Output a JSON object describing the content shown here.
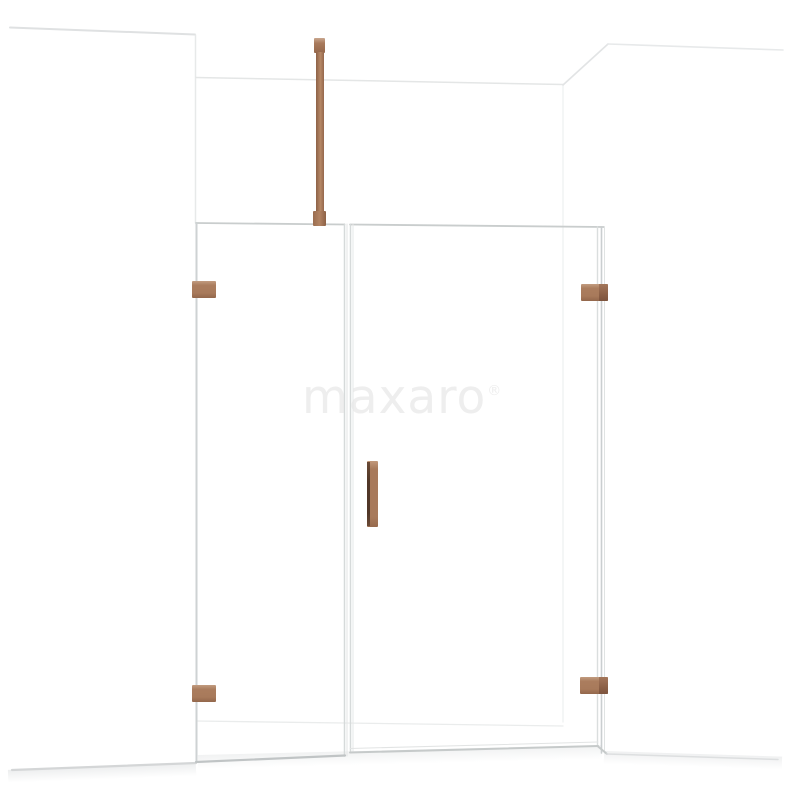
{
  "scene": {
    "background_color": "#ffffff",
    "subject": "walk-in shower enclosure render: left fixed glass panel, hinged glass door, right side glass panel, copper hardware, ceiling support bar, white alcove walls"
  },
  "watermark": {
    "brand": "maxaro",
    "registered_mark": "®",
    "color": "#eeeeee"
  },
  "colors": {
    "hardware_copper": "#a87a5c",
    "hardware_copper_dark": "#8c6047",
    "hardware_copper_light": "#c7a58d",
    "handle_edge_dark": "#503627",
    "glass_edge": "#ccd0d1",
    "wall_line": "#e3e5e6",
    "floor_line": "#c0c4c5",
    "floor_shadow": "#c6cacb"
  },
  "hardware_parts": [
    "ceiling-support-bar",
    "hinge-left-top",
    "hinge-left-bottom",
    "hinge-right-top",
    "hinge-right-bottom",
    "door-handle"
  ],
  "glass_panels": [
    "fixed-panel-left",
    "hinged-door",
    "side-panel-right"
  ]
}
